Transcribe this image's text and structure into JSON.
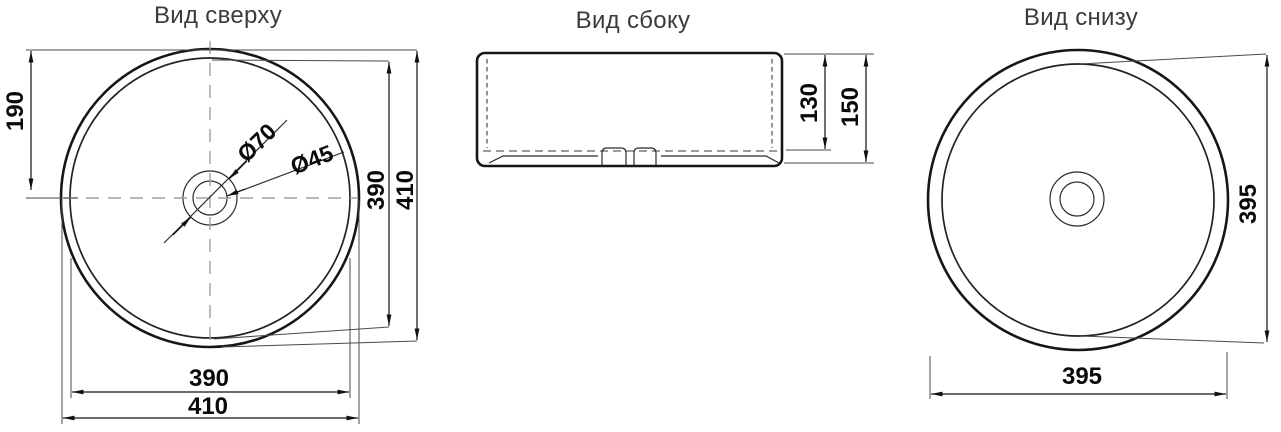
{
  "top_view": {
    "title": "Вид сверху",
    "dim_top_to_center": "190",
    "dim_inner_diameter_vertical": "390",
    "dim_outer_diameter_vertical": "410",
    "dim_inner_diameter_horizontal": "390",
    "dim_outer_diameter_horizontal": "410",
    "dim_drain_outer_diameter": "Ø70",
    "dim_drain_hole_diameter": "Ø45"
  },
  "side_view": {
    "title": "Вид сбоку",
    "dim_bowl_depth": "130",
    "dim_total_height": "150"
  },
  "bottom_view": {
    "title": "Вид снизу",
    "dim_base_diameter_vertical": "395",
    "dim_base_diameter_horizontal": "395"
  },
  "colors": {
    "background": "#ffffff",
    "object_line": "#161616",
    "dimension_line": "#111111",
    "centerline": "#a0a0a0",
    "dimension_text": "#0a0a0a",
    "title_text": "#3b3b3b"
  }
}
